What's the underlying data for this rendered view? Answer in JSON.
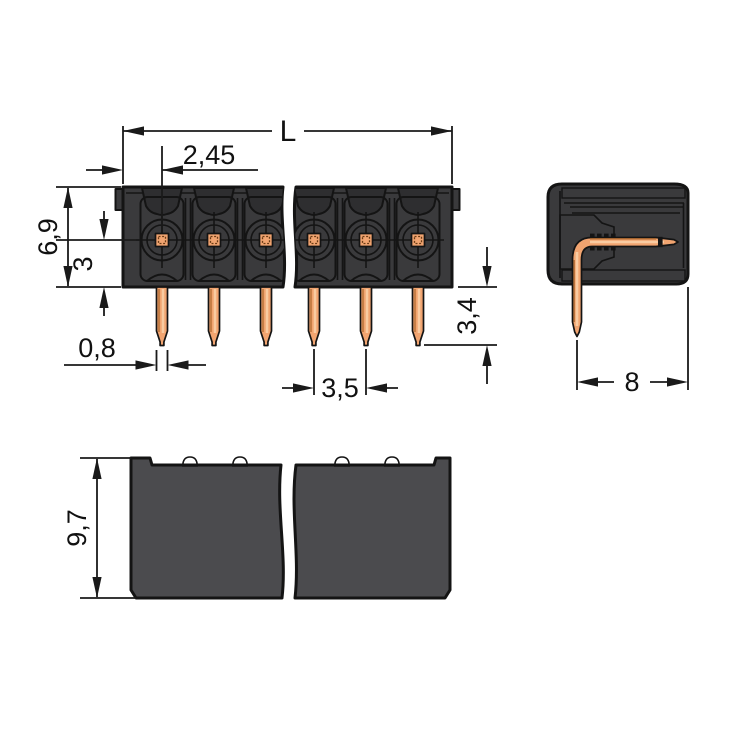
{
  "drawing": {
    "background_color": "#ffffff",
    "line_color": "#1a1a1a",
    "housing_color": "#3a3a3c",
    "housing_bottom_view_color": "#4b4b4e",
    "copper_pin_color": "#f1a470",
    "pin_dome_color": "#5d6b77"
  },
  "dimensions": {
    "total_length": "L",
    "first_pin_offset": "2,45",
    "housing_height": "6,9",
    "pin_axis_to_housing_bottom": "3",
    "pin_width": "0,8",
    "pin_pitch": "3,5",
    "pin_protrusion": "3,4",
    "housing_depth": "8",
    "overall_height": "9,7"
  }
}
